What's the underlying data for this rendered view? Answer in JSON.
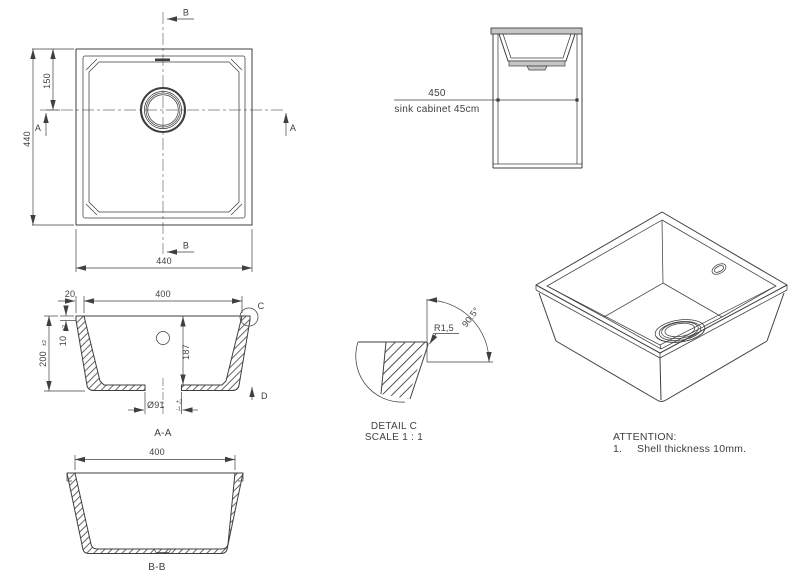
{
  "colors": {
    "line": "#3f3f3f",
    "background": "#ffffff",
    "fill_light": "#c6c6c6"
  },
  "plan_view": {
    "dim_width": "440",
    "dim_height": "440",
    "dim_drain_offset": "150",
    "section_a_label": "A",
    "section_b_label": "B"
  },
  "cabinet_view": {
    "dim_width": "450",
    "caption": "sink cabinet 45cm"
  },
  "section_aa": {
    "title": "A-A",
    "dim_inner_width": "400",
    "dim_wall_top": "20",
    "dim_height": "200",
    "dim_height_tol": "±2",
    "dim_rim_thickness": "10",
    "dim_rim_thickness_tol": "±2",
    "dim_depth": "187",
    "dim_drain": "Ø91",
    "dim_drain_tol_plus": "+2",
    "dim_drain_tol_minus": "-1",
    "detail_label": "C",
    "direction_label": "D"
  },
  "section_bb": {
    "title": "B-B",
    "dim_inner_width": "400"
  },
  "detail_c": {
    "dim_radius": "R1,5",
    "dim_angle": "90.5°",
    "title": "DETAIL C",
    "scale": "SCALE 1 : 1"
  },
  "notes": {
    "heading": "ATTENTION:",
    "item_number": "1.",
    "item_text": "Shell thickness 10mm."
  }
}
